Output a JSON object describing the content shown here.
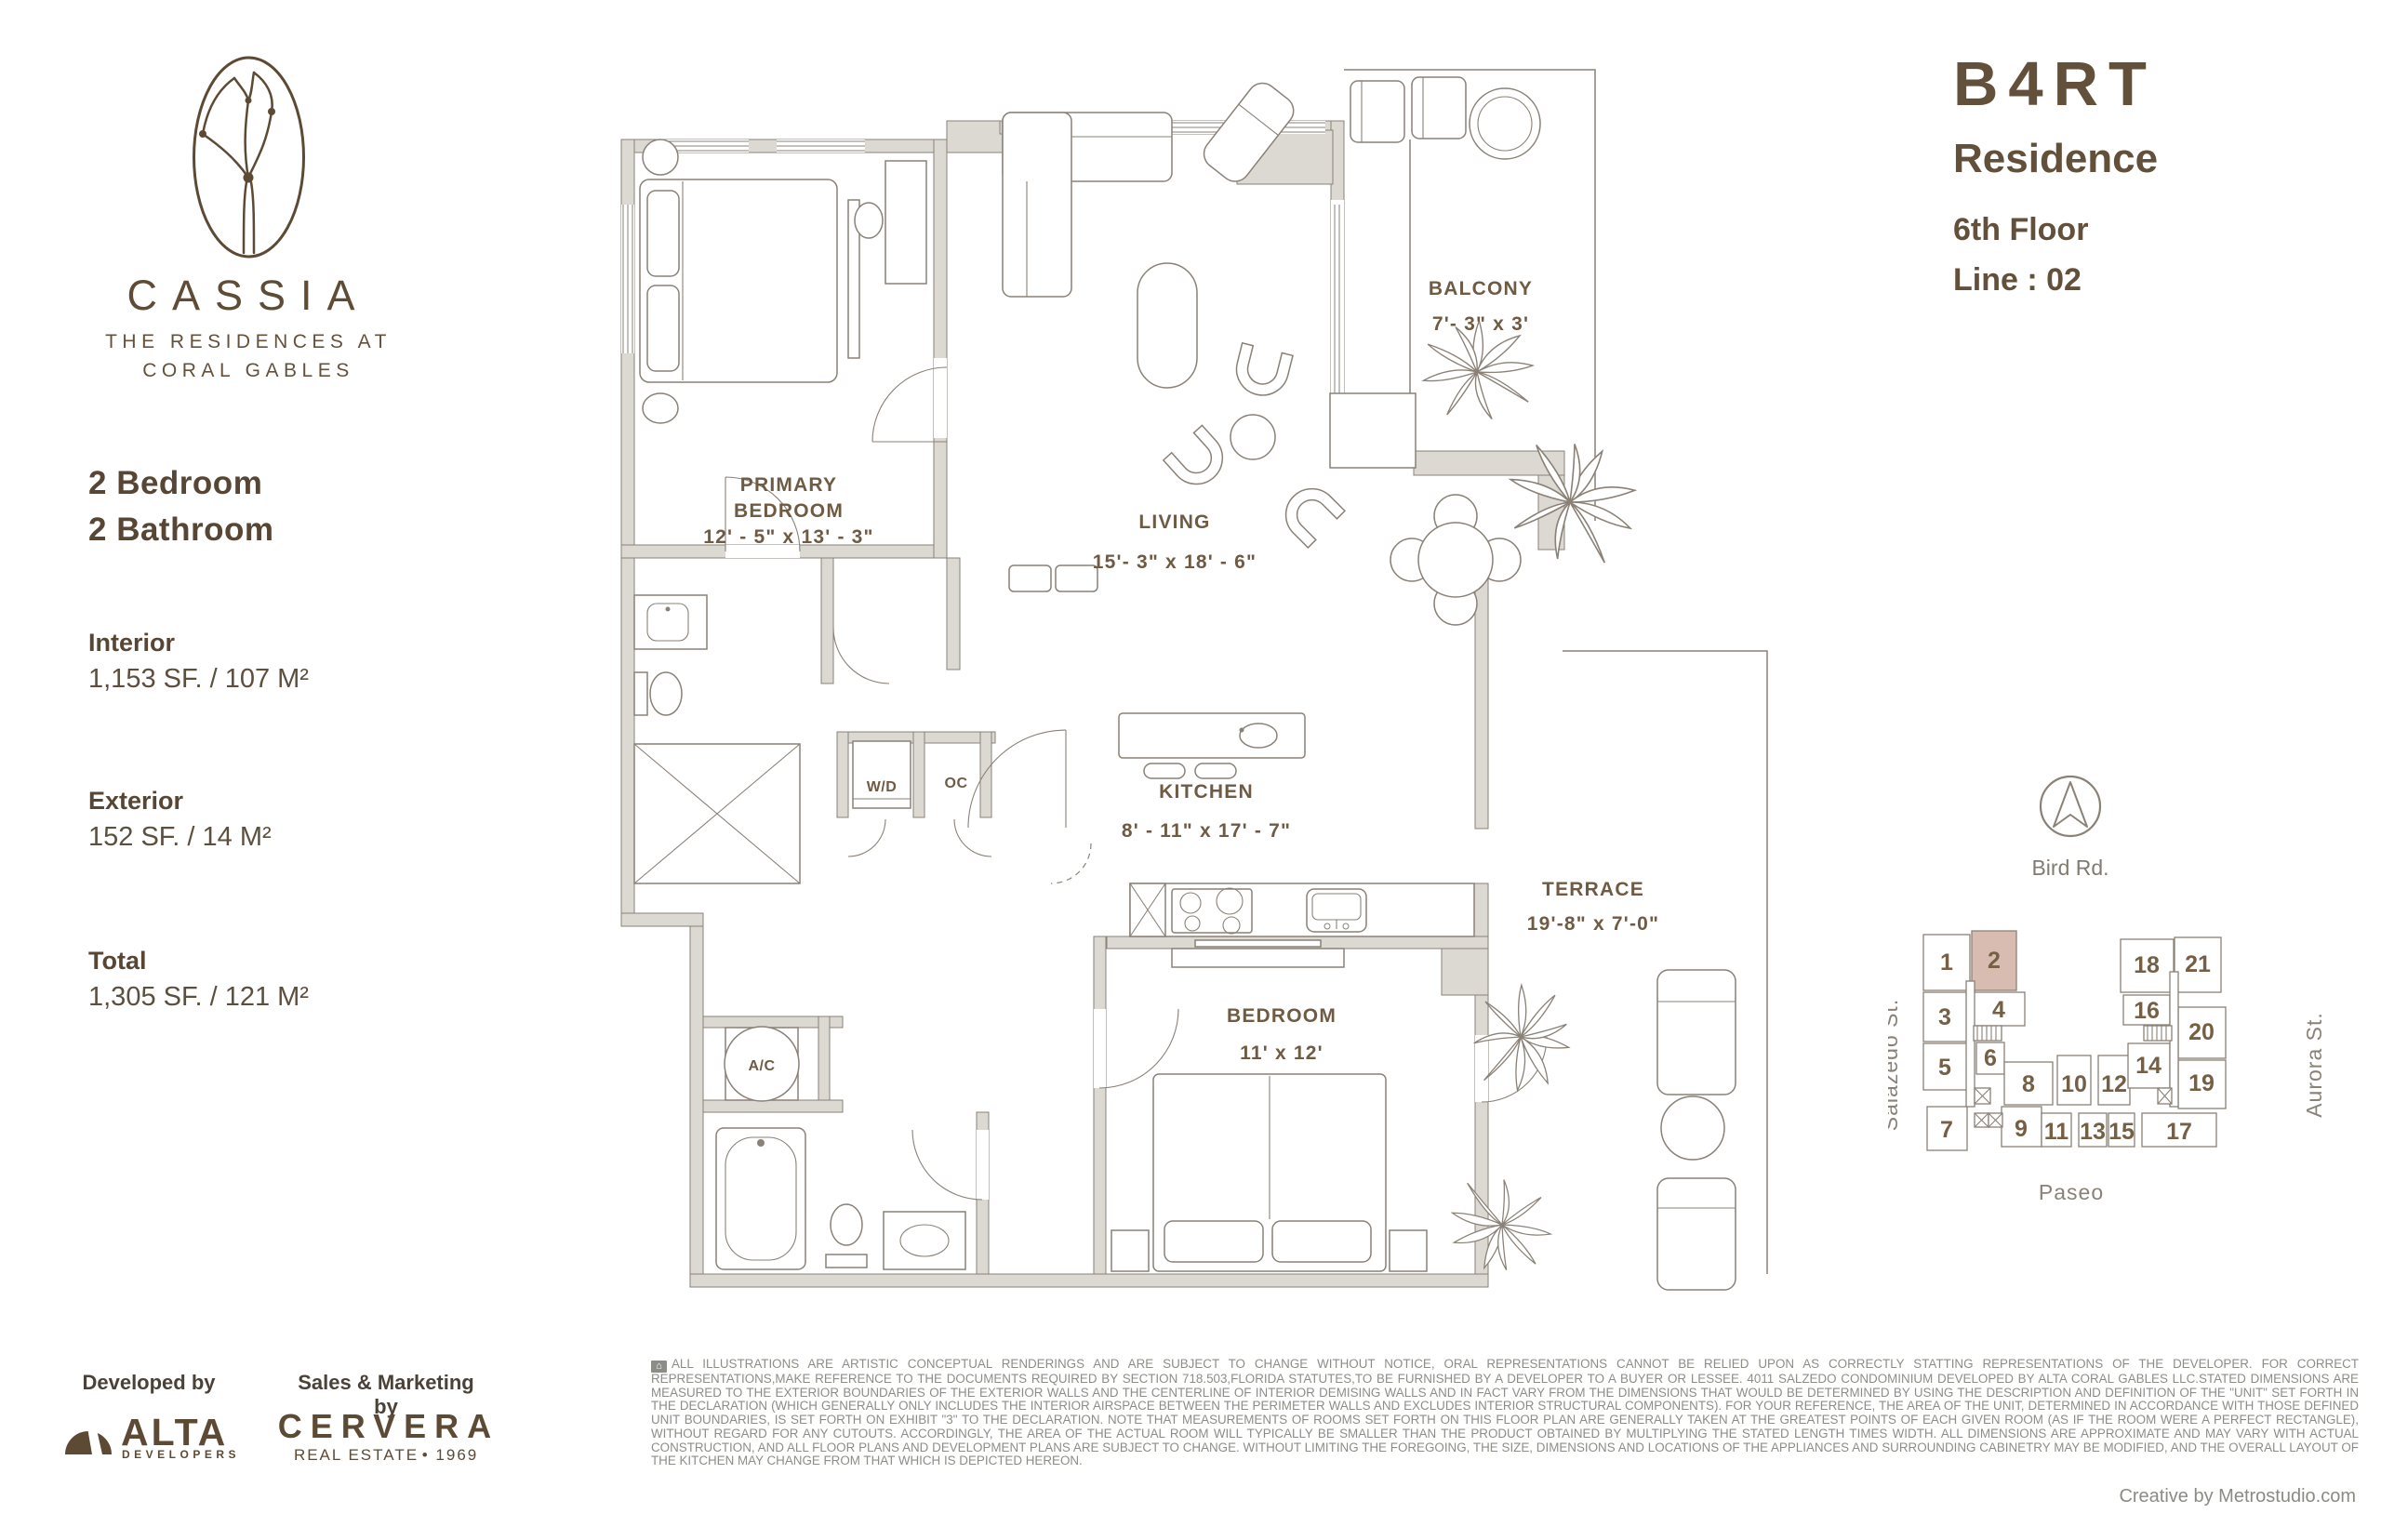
{
  "brand": {
    "name": "CASSIA",
    "tagline_line1": "THE RESIDENCES AT",
    "tagline_line2": "CORAL GABLES"
  },
  "unit": {
    "model": "B4RT",
    "type_label": "Residence",
    "floor": "6th Floor",
    "line": "Line : 02",
    "bedrooms": "2 Bedroom",
    "bathrooms": "2 Bathroom",
    "interior_label": "Interior",
    "interior_value": "1,153 SF. / 107 M²",
    "exterior_label": "Exterior",
    "exterior_value": "152 SF. / 14 M²",
    "total_label": "Total",
    "total_value": "1,305 SF. / 121 M²"
  },
  "plan": {
    "rooms": {
      "primary": {
        "l1": "PRIMARY",
        "l2": "BEDROOM",
        "dims": "12' - 5\" x 13' - 3\""
      },
      "living": {
        "l1": "LIVING",
        "dims": "15'- 3\" x 18' - 6\""
      },
      "balcony": {
        "l1": "BALCONY",
        "dims": "7'- 3\" x 3'"
      },
      "kitchen": {
        "l1": "KITCHEN",
        "dims": "8' - 11\" x 17' - 7\""
      },
      "terrace": {
        "l1": "TERRACE",
        "dims": "19'-8\" x 7'-0\""
      },
      "bedroom": {
        "l1": "BEDROOM",
        "dims": "11' x 12'"
      }
    },
    "closets": {
      "wd": "W/D",
      "oc": "OC",
      "ac": "A/C"
    }
  },
  "keyplan": {
    "streets": {
      "top": "Bird Rd.",
      "left": "Salazedo St.",
      "right": "Aurora St.",
      "bottom": "Paseo"
    },
    "highlighted_unit": "2",
    "units": [
      "1",
      "2",
      "3",
      "4",
      "5",
      "6",
      "7",
      "8",
      "9",
      "10",
      "11",
      "12",
      "13",
      "14",
      "15",
      "16",
      "17",
      "18",
      "19",
      "20",
      "21"
    ]
  },
  "footer": {
    "developed_by": "Developed by",
    "alta_name": "ALTA",
    "alta_sub": "DEVELOPERS",
    "sales_by": "Sales & Marketing by",
    "cervera_name": "CERVERA",
    "cervera_sub": "REAL ESTATE",
    "cervera_year": "• 1969",
    "house_icon_glyph": "⌂",
    "disclaimer": "ALL ILLUSTRATIONS ARE ARTISTIC CONCEPTUAL RENDERINGS AND ARE SUBJECT TO CHANGE WITHOUT NOTICE, ORAL REPRESENTATIONS CANNOT BE RELIED UPON AS CORRECTLY STATTING REPRESENTATIONS OF THE DEVELOPER. FOR CORRECT REPRESENTATIONS,MAKE REFERENCE TO THE DOCUMENTS REQUIRED BY SECTION 718.503,FLORIDA STATUTES,TO BE FURNISHED BY A DEVELOPER TO A BUYER OR LESSEE. 4011 SALZEDO CONDOMINIUM DEVELOPED BY ALTA CORAL GABLES LLC.STATED DIMENSIONS ARE MEASURED TO THE EXTERIOR BOUNDARIES OF THE EXTERIOR WALLS AND THE CENTERLINE OF INTERIOR DEMISING WALLS AND IN FACT VARY FROM THE DIMENSIONS THAT WOULD BE DETERMINED BY USING THE DESCRIPTION AND DEFINITION OF THE \"UNIT\" SET FORTH IN THE DECLARATION (WHICH GENERALLY ONLY INCLUDES THE INTERIOR AIRSPACE BETWEEN THE PERIMETER WALLS AND EXCLUDES INTERIOR STRUCTURAL COMPONENTS).  FOR YOUR REFERENCE, THE AREA OF THE UNIT, DETERMINED IN ACCORDANCE WITH THOSE DEFINED UNIT BOUNDARIES, IS SET FORTH ON EXHIBIT \"3\" TO THE DECLARATION.  NOTE THAT MEASUREMENTS OF ROOMS SET FORTH ON THIS FLOOR PLAN ARE GENERALLY TAKEN AT THE GREATEST POINTS OF EACH GIVEN ROOM (AS IF THE ROOM WERE A PERFECT RECTANGLE), WITHOUT REGARD FOR ANY CUTOUTS.  ACCORDINGLY, THE AREA OF THE ACTUAL ROOM WILL TYPICALLY BE SMALLER THAN THE PRODUCT OBTAINED BY MULTIPLYING THE STATED LENGTH TIMES WIDTH.  ALL DIMENSIONS ARE APPROXIMATE AND MAY VARY WITH ACTUAL CONSTRUCTION, AND ALL FLOOR PLANS AND DEVELOPMENT PLANS ARE SUBJECT TO CHANGE.  WITHOUT LIMITING THE FOREGOING, THE SIZE, DIMENSIONS AND LOCATIONS OF THE APPLIANCES AND SURROUNDING CABINETRY MAY BE MODIFIED, AND THE OVERALL LAYOUT OF THE KITCHEN MAY CHANGE FROM THAT WHICH IS DEPICTED HEREON.",
    "credit": "Creative by Metrostudio.com"
  },
  "colors": {
    "brand_brown": "#63503a",
    "logo_brown": "#5d4a34",
    "wall_gray": "#dcd9d3",
    "line_gray": "#8a8177",
    "highlight_unit": "#d9bcb1",
    "disclaimer_gray": "#8d8d88"
  }
}
